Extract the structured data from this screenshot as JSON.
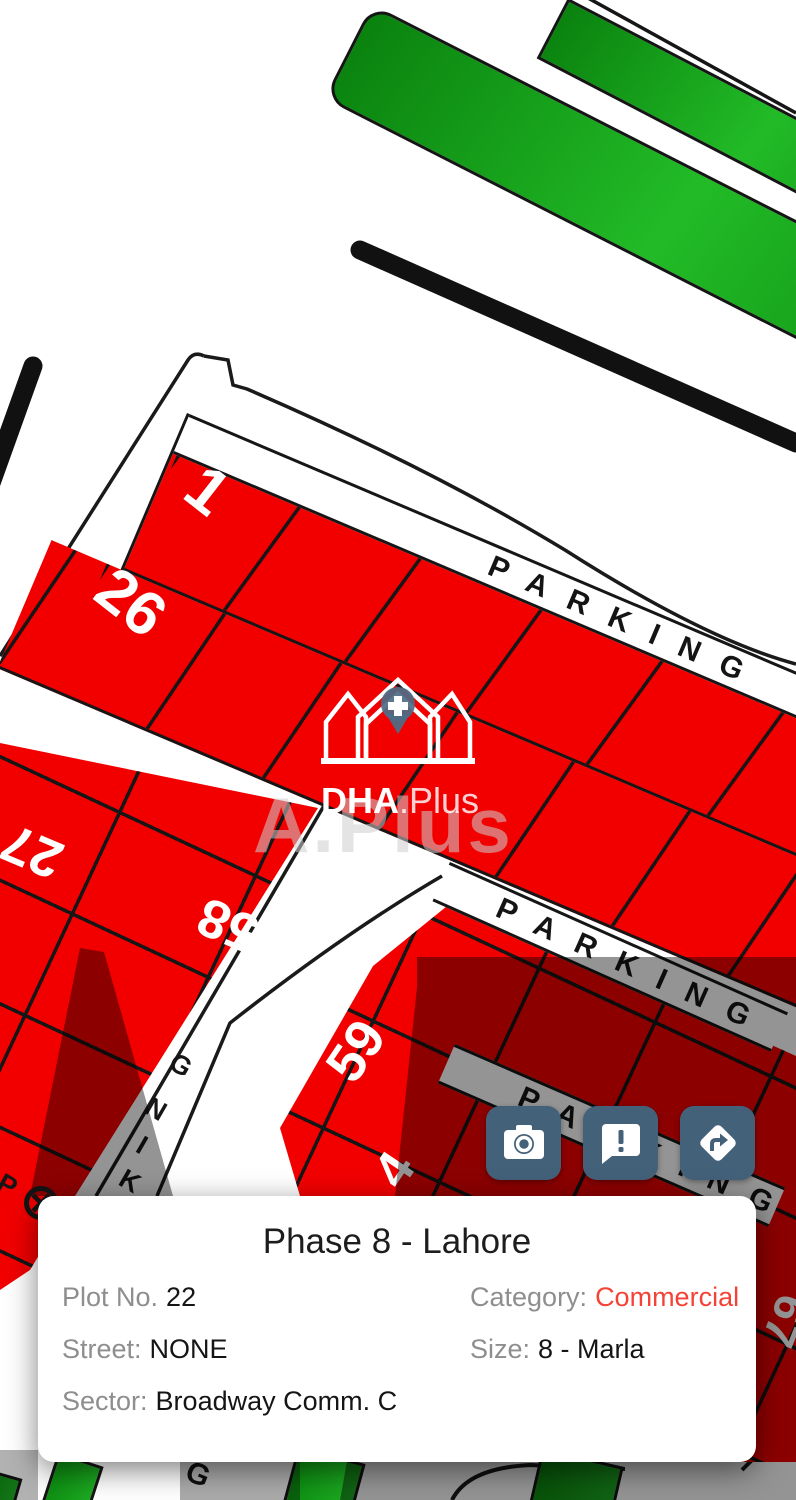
{
  "map": {
    "parking_label": "PARKING",
    "plot_labels": {
      "one": "1",
      "twentysix": "26",
      "twentyseven": "27",
      "fiftyeight": "58",
      "fiftynine": "59",
      "four": "4",
      "sixtyseven": "67"
    },
    "road_letters": {
      "p": "P",
      "k": "K",
      "i": "I",
      "n": "N",
      "g": "G",
      "g2": "G"
    }
  },
  "watermark": {
    "brand": "DHA",
    "suffix": ".Plus",
    "ghost": "A.Plus"
  },
  "actions": {
    "camera": "camera",
    "report": "report",
    "directions": "directions"
  },
  "card": {
    "title": "Phase 8 - Lahore",
    "plot_label": "Plot No.",
    "plot_value": "22",
    "category_label": "Category:",
    "category_value": "Commercial",
    "street_label": "Street:",
    "street_value": "NONE",
    "size_label": "Size:",
    "size_value": "8 - Marla",
    "sector_label": "Sector:",
    "sector_value": "Broadway Comm. C"
  },
  "colors": {
    "plot_red": "#f20000",
    "button_slate": "#44617a",
    "green": "#15a11a",
    "category_value_style": "color:#f44336"
  }
}
